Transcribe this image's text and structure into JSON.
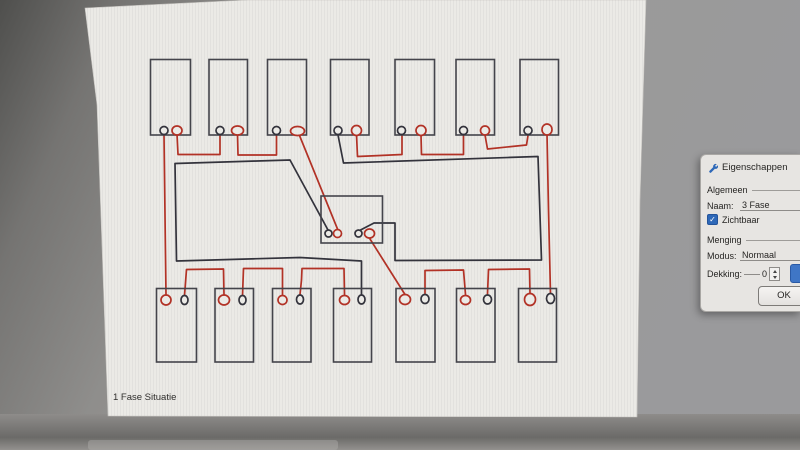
{
  "panel": {
    "title": "Eigenschappen",
    "general_label": "Algemeen",
    "naam_label": "Naam:",
    "naam_value": "3 Fase",
    "zichtbaar_label": "Zichtbaar",
    "zichtbaar_checked": "✓",
    "menging_label": "Menging",
    "modus_label": "Modus:",
    "modus_value": "Normaal",
    "dekking_label": "Dekking:",
    "dekking_value": "0",
    "ok_label": "OK",
    "accent_color": "#2e68b8"
  },
  "diagram": {
    "caption": "1 Fase Situatie",
    "colors": {
      "red": "#b23226",
      "black": "#33333c",
      "outline": "#44444b",
      "canvas": "#ebeae6"
    },
    "wires": [
      {
        "color": "black",
        "points": [
          [
            361.5,
            297
          ],
          [
            361.5,
            261
          ],
          [
            300,
            257.5
          ],
          [
            176.5,
            261
          ],
          [
            175,
            163.5
          ],
          [
            290,
            160
          ],
          [
            328,
            230
          ]
        ]
      },
      {
        "color": "black",
        "points": [
          [
            338,
            135
          ],
          [
            343.5,
            163
          ],
          [
            538,
            156.5
          ],
          [
            541.5,
            260
          ],
          [
            395,
            260.5
          ],
          [
            395,
            223
          ],
          [
            374,
            223
          ],
          [
            360.5,
            230
          ]
        ]
      },
      {
        "color": "red",
        "points": [
          [
            164,
            135
          ],
          [
            166,
            295
          ]
        ]
      },
      {
        "color": "red",
        "points": [
          [
            177,
            134
          ],
          [
            178,
            154.5
          ],
          [
            220,
            154.5
          ],
          [
            220,
            135.5
          ]
        ]
      },
      {
        "color": "red",
        "points": [
          [
            237.5,
            134.5
          ],
          [
            238,
            155
          ],
          [
            276.5,
            155
          ],
          [
            276.5,
            135.5
          ]
        ]
      },
      {
        "color": "red",
        "points": [
          [
            299.5,
            135.5
          ],
          [
            337.5,
            229
          ]
        ]
      },
      {
        "color": "red",
        "points": [
          [
            356.5,
            134.5
          ],
          [
            357.5,
            156.5
          ],
          [
            402,
            154.5
          ],
          [
            402,
            135.5
          ]
        ]
      },
      {
        "color": "red",
        "points": [
          [
            421,
            135
          ],
          [
            421.5,
            154.5
          ],
          [
            463.5,
            154.5
          ],
          [
            463.5,
            135.5
          ]
        ]
      },
      {
        "color": "red",
        "points": [
          [
            485,
            135
          ],
          [
            487.5,
            149
          ],
          [
            526.5,
            145
          ],
          [
            528,
            135.5
          ]
        ]
      },
      {
        "color": "red",
        "points": [
          [
            547,
            134
          ],
          [
            548.5,
            210
          ],
          [
            550.5,
            293.5
          ]
        ]
      },
      {
        "color": "red",
        "points": [
          [
            370,
            239
          ],
          [
            405,
            294.5
          ]
        ]
      },
      {
        "color": "red",
        "points": [
          [
            184.5,
            295.5
          ],
          [
            186.5,
            269.5
          ],
          [
            223.5,
            269
          ],
          [
            224,
            295
          ]
        ]
      },
      {
        "color": "red",
        "points": [
          [
            242.5,
            295.5
          ],
          [
            243.5,
            268.5
          ],
          [
            282.5,
            268.5
          ],
          [
            282.5,
            294.5
          ]
        ]
      },
      {
        "color": "red",
        "points": [
          [
            300,
            294.5
          ],
          [
            301.5,
            280
          ],
          [
            302,
            268.5
          ],
          [
            344,
            268.5
          ],
          [
            344.5,
            294.5
          ]
        ]
      },
      {
        "color": "red",
        "points": [
          [
            425,
            293.5
          ],
          [
            425,
            270.5
          ],
          [
            463.5,
            270
          ],
          [
            465.5,
            294.5
          ]
        ]
      },
      {
        "color": "red",
        "points": [
          [
            487.5,
            294
          ],
          [
            488.5,
            269.5
          ],
          [
            529.5,
            269
          ],
          [
            530,
            293.5
          ]
        ]
      }
    ],
    "components": [
      {
        "name": "top-lamp-1",
        "x": 150.5,
        "y": 59.5,
        "w": 40,
        "h": 75.5,
        "terminals": [
          {
            "cx": 164,
            "cy": 130.5,
            "rx": 4,
            "ry": 4,
            "color": "black"
          },
          {
            "cx": 177,
            "cy": 130.5,
            "rx": 5,
            "ry": 4.5,
            "color": "red"
          }
        ]
      },
      {
        "name": "top-lamp-2",
        "x": 209,
        "y": 59.5,
        "w": 38.5,
        "h": 75.5,
        "terminals": [
          {
            "cx": 220,
            "cy": 130.5,
            "rx": 4,
            "ry": 4,
            "color": "black"
          },
          {
            "cx": 237.5,
            "cy": 130.5,
            "rx": 6,
            "ry": 4.5,
            "color": "red"
          }
        ]
      },
      {
        "name": "top-lamp-3",
        "x": 267.5,
        "y": 59.5,
        "w": 39,
        "h": 75.5,
        "terminals": [
          {
            "cx": 276.5,
            "cy": 130.5,
            "rx": 4,
            "ry": 4,
            "color": "black"
          },
          {
            "cx": 297.5,
            "cy": 131,
            "rx": 7,
            "ry": 4.5,
            "color": "red"
          }
        ]
      },
      {
        "name": "top-lamp-4",
        "x": 330.5,
        "y": 59.5,
        "w": 38.5,
        "h": 75.5,
        "terminals": [
          {
            "cx": 338,
            "cy": 130.5,
            "rx": 4,
            "ry": 4,
            "color": "black"
          },
          {
            "cx": 356.5,
            "cy": 130.5,
            "rx": 5,
            "ry": 5,
            "color": "red"
          }
        ]
      },
      {
        "name": "top-lamp-5",
        "x": 395,
        "y": 59.5,
        "w": 39.5,
        "h": 75.5,
        "terminals": [
          {
            "cx": 401.5,
            "cy": 130.5,
            "rx": 4,
            "ry": 4,
            "color": "black"
          },
          {
            "cx": 421,
            "cy": 130.5,
            "rx": 5,
            "ry": 5,
            "color": "red"
          }
        ]
      },
      {
        "name": "top-lamp-6",
        "x": 456,
        "y": 59.5,
        "w": 38.5,
        "h": 75.5,
        "terminals": [
          {
            "cx": 463.5,
            "cy": 130.5,
            "rx": 4,
            "ry": 4,
            "color": "black"
          },
          {
            "cx": 485,
            "cy": 130.5,
            "rx": 4.5,
            "ry": 4.5,
            "color": "red"
          }
        ]
      },
      {
        "name": "top-lamp-7",
        "x": 520,
        "y": 59.5,
        "w": 38.5,
        "h": 75.5,
        "terminals": [
          {
            "cx": 528,
            "cy": 130.5,
            "rx": 4,
            "ry": 4,
            "color": "black"
          },
          {
            "cx": 547,
            "cy": 129.5,
            "rx": 5,
            "ry": 5.5,
            "color": "red"
          }
        ]
      },
      {
        "name": "bottom-lamp-1",
        "x": 156.5,
        "y": 288.5,
        "w": 40,
        "h": 73.5,
        "terminals": [
          {
            "cx": 166,
            "cy": 300,
            "rx": 5,
            "ry": 5,
            "color": "red"
          },
          {
            "cx": 184.5,
            "cy": 300,
            "rx": 3.5,
            "ry": 4.5,
            "color": "black"
          }
        ]
      },
      {
        "name": "bottom-lamp-2",
        "x": 215,
        "y": 288.5,
        "w": 38.5,
        "h": 73.5,
        "terminals": [
          {
            "cx": 224,
            "cy": 300,
            "rx": 5.5,
            "ry": 5,
            "color": "red"
          },
          {
            "cx": 242.5,
            "cy": 300,
            "rx": 3.5,
            "ry": 4.5,
            "color": "black"
          }
        ]
      },
      {
        "name": "bottom-lamp-3",
        "x": 272.5,
        "y": 288.5,
        "w": 38.5,
        "h": 73.5,
        "terminals": [
          {
            "cx": 282.5,
            "cy": 300,
            "rx": 4.5,
            "ry": 4.5,
            "color": "red"
          },
          {
            "cx": 300,
            "cy": 299.5,
            "rx": 3.5,
            "ry": 4.5,
            "color": "black"
          }
        ]
      },
      {
        "name": "bottom-lamp-4",
        "x": 333.5,
        "y": 288.5,
        "w": 38,
        "h": 73.5,
        "terminals": [
          {
            "cx": 344.5,
            "cy": 300,
            "rx": 5,
            "ry": 4.5,
            "color": "red"
          },
          {
            "cx": 361.5,
            "cy": 299.5,
            "rx": 3.5,
            "ry": 4.5,
            "color": "black"
          }
        ]
      },
      {
        "name": "bottom-lamp-5",
        "x": 396,
        "y": 288.5,
        "w": 39,
        "h": 73.5,
        "terminals": [
          {
            "cx": 405,
            "cy": 299.5,
            "rx": 5.5,
            "ry": 5,
            "color": "red"
          },
          {
            "cx": 425,
            "cy": 299,
            "rx": 4,
            "ry": 4.5,
            "color": "black"
          }
        ]
      },
      {
        "name": "bottom-lamp-6",
        "x": 456.5,
        "y": 288.5,
        "w": 38.5,
        "h": 73.5,
        "terminals": [
          {
            "cx": 465.5,
            "cy": 300,
            "rx": 5,
            "ry": 4.5,
            "color": "red"
          },
          {
            "cx": 487.5,
            "cy": 299.5,
            "rx": 4,
            "ry": 4.5,
            "color": "black"
          }
        ]
      },
      {
        "name": "bottom-lamp-7",
        "x": 518.5,
        "y": 288.5,
        "w": 38,
        "h": 73.5,
        "terminals": [
          {
            "cx": 530,
            "cy": 299.5,
            "rx": 5.5,
            "ry": 6,
            "color": "red"
          },
          {
            "cx": 550.5,
            "cy": 298.5,
            "rx": 4,
            "ry": 5,
            "color": "black"
          }
        ]
      },
      {
        "name": "junction-box",
        "x": 321,
        "y": 196,
        "w": 61.5,
        "h": 47,
        "terminals": [
          {
            "cx": 328.5,
            "cy": 233.5,
            "rx": 3.5,
            "ry": 3.5,
            "color": "black"
          },
          {
            "cx": 337.5,
            "cy": 233.5,
            "rx": 4,
            "ry": 4,
            "color": "red"
          },
          {
            "cx": 358.5,
            "cy": 233.5,
            "rx": 3.5,
            "ry": 3.5,
            "color": "black"
          },
          {
            "cx": 369.5,
            "cy": 233.5,
            "rx": 5,
            "ry": 4.5,
            "color": "red"
          }
        ]
      }
    ]
  }
}
